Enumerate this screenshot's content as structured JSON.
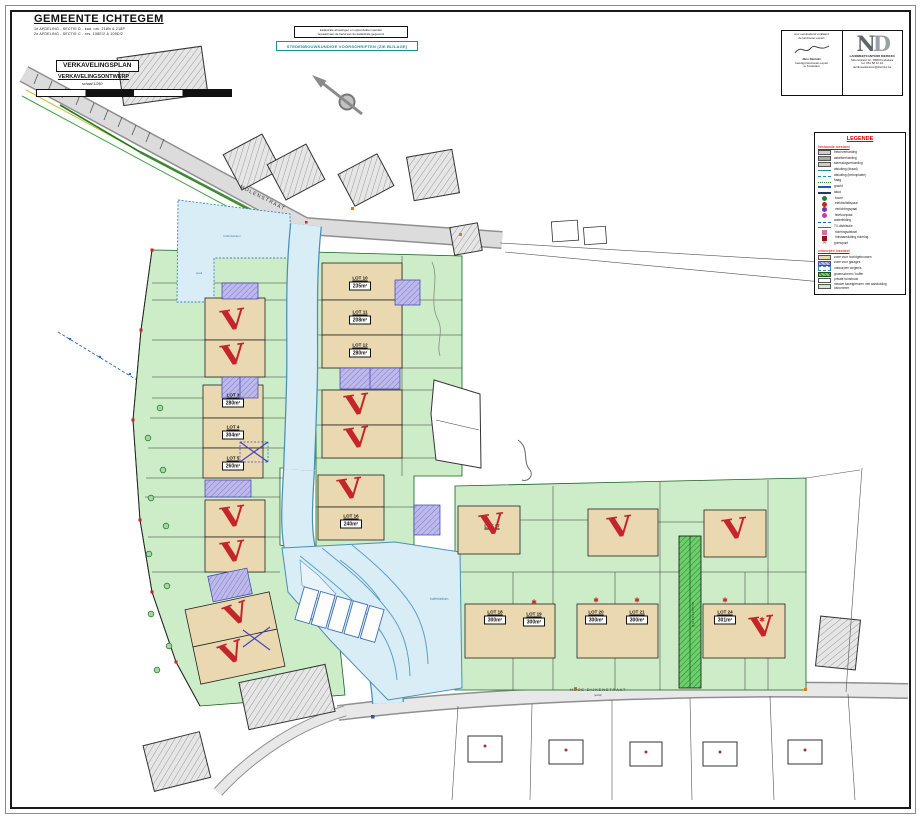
{
  "title_block": {
    "municipality": "GEMEENTE ICHTEGEM",
    "cadastral_line1": "1e AFDELING - SECTIE D - kad. nrs. 218N & 218P",
    "cadastral_line2": "2e AFDELING - SECTIE C - nrs. 138E/2 & 109D/2",
    "plan_type": "VERKAVELINGSPLAN",
    "subtitle": "VERKAVELINGSONTWERP",
    "scale": "schaal 1/250"
  },
  "notes": {
    "disclaimer_line1": "kadastrale afmetingen en oppervlakten werden",
    "disclaimer_line2": "bepaald aan de hand van de kadastrale gegevens",
    "regulations": "STEDENBOUWKUNDIGE VOORSCHRIFTEN (ZIE BIJLAGE)"
  },
  "surveyor": {
    "left": {
      "line1": "voor eensluidend verklaard,",
      "line2": "de landmeter-expert:",
      "line3": "Nico Dierickx",
      "line4": "beëdigd landmeter-expert",
      "line5": "te Koekelare"
    },
    "logo": {
      "n": "N",
      "d": "D"
    },
    "right": {
      "line1": "LANDMEETKANTOOR DIERICKX",
      "line2": "Moerestraat 12 - 8680 Koekelare",
      "line3": "tel. 051 58 12 34",
      "line4": "landmeetkantoor@dierickx.be"
    }
  },
  "legend": {
    "title": "LEGENDE",
    "existing_title": "bestaande toestand",
    "proposed_title": "ontworpen toestand",
    "existing": [
      {
        "symbol": "sw-gray",
        "label": "betonverharding"
      },
      {
        "symbol": "sw-darkgray",
        "label": "asfaltverharding"
      },
      {
        "symbol": "sw-tan",
        "label": "steenslagverharding"
      },
      {
        "symbol": "ln-teal",
        "label": "afsluiting (draad)"
      },
      {
        "symbol": "ln-teal-dash",
        "label": "afsluiting (betonplaten)"
      },
      {
        "symbol": "ln-green-scallop",
        "label": "haag"
      },
      {
        "symbol": "ln-blue-double",
        "label": "gracht"
      },
      {
        "symbol": "ln-navy",
        "label": "talud"
      },
      {
        "symbol": "dot-green",
        "label": "boom"
      },
      {
        "symbol": "dot-red",
        "label": "elektriciteitspaal"
      },
      {
        "symbol": "dot-purple",
        "label": "verlichtingspaal"
      },
      {
        "symbol": "dot-magenta",
        "label": "telefoonpaal"
      },
      {
        "symbol": "ln-blue-dot",
        "label": "waterleiding"
      },
      {
        "symbol": "ln-brown",
        "label": "TV-distributie"
      },
      {
        "symbol": "sq-pink",
        "label": "rioleringsdeksel"
      },
      {
        "symbol": "sq-darkred",
        "label": "huisaansluiting riolering"
      },
      {
        "symbol": "x-red",
        "label": "grenspunt"
      }
    ],
    "proposed": [
      {
        "symbol": "sw-beige",
        "label": "zone voor hoofdgebouwen"
      },
      {
        "symbol": "sw-purple",
        "label": "zone voor garages"
      },
      {
        "symbol": "sw-bluedash",
        "label": "ontworpen wegenis"
      },
      {
        "symbol": "sw-greenhatch",
        "label": "groenscherm / buffer"
      },
      {
        "symbol": "sw-white",
        "label": "private tuinstrook"
      },
      {
        "symbol": "sw-lightgreen",
        "label": "nieuwe kavelgrenzen met aanduiding lotnummer"
      }
    ]
  },
  "map": {
    "streets": {
      "top": "MOLENSTRAAT",
      "bottom": "HOGE DIJKENSTRAAT",
      "bottom_sub": "(asfalt)"
    },
    "water_labels": {
      "pond": "bufferbekken",
      "wadi": "wadi",
      "basin": "bufferbekken"
    },
    "buffer_label": "groenscherm",
    "marks": {
      "sold_glyph": "V",
      "star_glyph": "✱"
    },
    "lots": [
      {
        "label": "LOT 1",
        "x": 233,
        "y": 322,
        "sold": true
      },
      {
        "label": "LOT 2",
        "x": 233,
        "y": 357,
        "sold": true
      },
      {
        "label": "LOT 3",
        "area": "280m²",
        "x": 233,
        "y": 400
      },
      {
        "label": "LOT 4",
        "area": "304m²",
        "x": 233,
        "y": 432
      },
      {
        "label": "LOT 5",
        "area": "260m²",
        "x": 233,
        "y": 463
      },
      {
        "label": "LOT 6",
        "x": 233,
        "y": 519,
        "sold": true
      },
      {
        "label": "LOT 7",
        "x": 233,
        "y": 554,
        "sold": true
      },
      {
        "label": "LOT 8",
        "x": 237,
        "y": 616,
        "sold": true,
        "rot": -12
      },
      {
        "label": "LOT 9",
        "x": 232,
        "y": 655,
        "sold": true,
        "rot": -12
      },
      {
        "label": "LOT 10",
        "area": "235m²",
        "x": 360,
        "y": 283
      },
      {
        "label": "LOT 11",
        "area": "208m²",
        "x": 360,
        "y": 317
      },
      {
        "label": "LOT 12",
        "area": "280m²",
        "x": 360,
        "y": 350
      },
      {
        "label": "LOT 13",
        "x": 357,
        "y": 407,
        "sold": true
      },
      {
        "label": "LOT 14",
        "x": 357,
        "y": 440,
        "sold": true
      },
      {
        "label": "LOT 15",
        "x": 350,
        "y": 491,
        "sold": true
      },
      {
        "label": "LOT 16",
        "area": "240m²",
        "x": 351,
        "y": 521
      },
      {
        "label": "LOT 17",
        "x": 492,
        "y": 526,
        "sold": true,
        "show_label": true
      },
      {
        "label": "LOT 18",
        "area": "300m²",
        "x": 495,
        "y": 617
      },
      {
        "label": "LOT 19",
        "area": "300m²",
        "x": 534,
        "y": 619,
        "star": true
      },
      {
        "label": "LOT 20",
        "area": "300m²",
        "x": 596,
        "y": 617,
        "star": true
      },
      {
        "label": "LOT 21",
        "area": "300m²",
        "x": 637,
        "y": 617,
        "star": true
      },
      {
        "label": "LOT 22",
        "x": 620,
        "y": 529,
        "sold": true
      },
      {
        "label": "LOT 23",
        "x": 735,
        "y": 531,
        "sold": true
      },
      {
        "label": "LOT 24",
        "area": "301m²",
        "x": 725,
        "y": 617,
        "star": true
      },
      {
        "label": "LOT 25",
        "x": 762,
        "y": 629,
        "sold": true,
        "star": true
      }
    ]
  }
}
